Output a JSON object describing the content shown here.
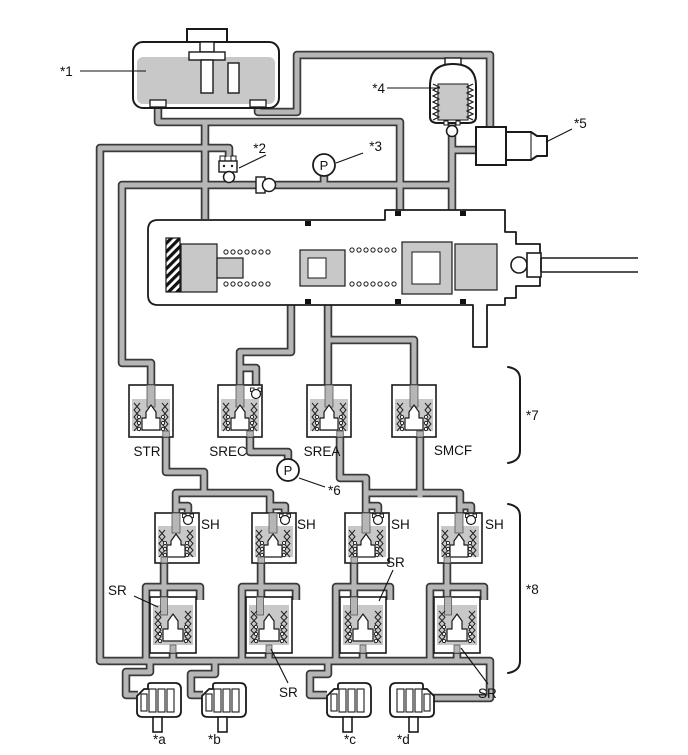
{
  "diagram": {
    "type": "hydraulic-brake-circuit-schematic",
    "gauge_letter": "P",
    "callouts": {
      "c1": "*1",
      "c2": "*2",
      "c3": "*3",
      "c4": "*4",
      "c5": "*5",
      "c6": "*6",
      "c7": "*7",
      "c8": "*8"
    },
    "wheel_callouts": {
      "a": "*a",
      "b": "*b",
      "c": "*c",
      "d": "*d"
    },
    "valve_labels": {
      "str": "STR",
      "srec": "SREC",
      "srea": "SREA",
      "smcf": "SMCF",
      "sh": "SH",
      "sr": "SR"
    },
    "colors": {
      "pipe_core": "#b6b6b6",
      "pipe_outline": "#3a3a3a",
      "fill_gray": "#c8c8c8",
      "line": "#1a1a1a",
      "background": "#ffffff"
    }
  }
}
